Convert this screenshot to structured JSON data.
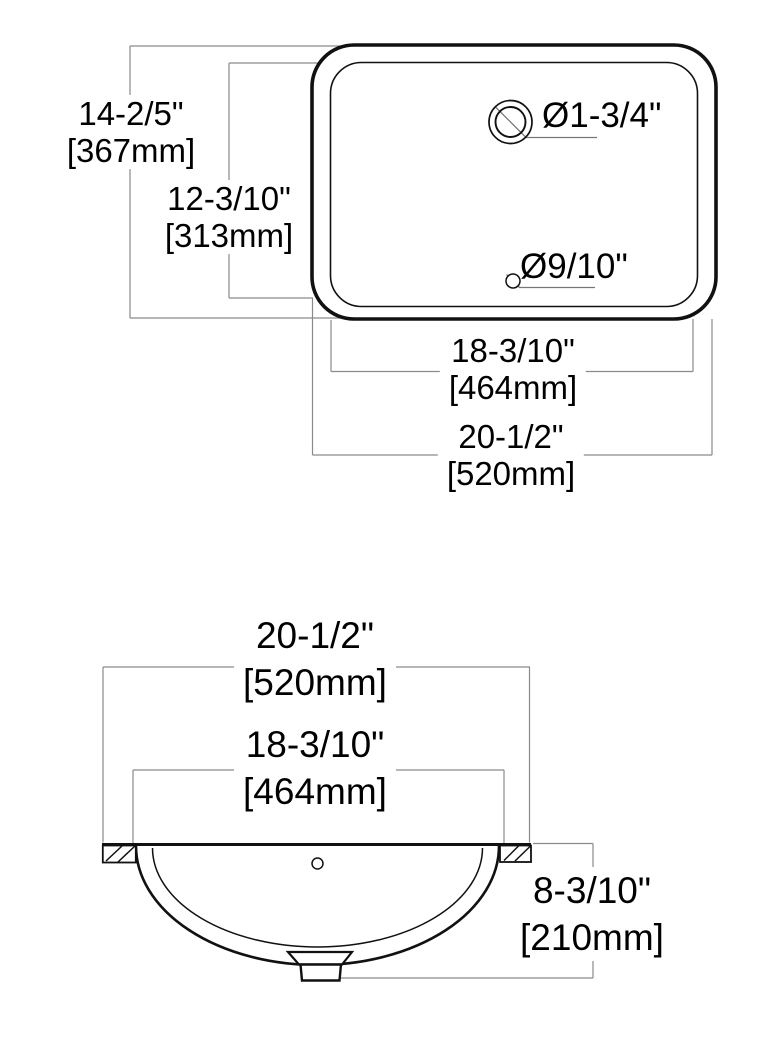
{
  "top_view": {
    "overall_height": {
      "inches": "14-2/5\"",
      "mm": "[367mm]"
    },
    "basin_height": {
      "inches": "12-3/10\"",
      "mm": "[313mm]"
    },
    "faucet_hole_diameter": "Ø1-3/4\"",
    "overflow_hole_diameter": "Ø9/10\"",
    "basin_width": {
      "inches": "18-3/10\"",
      "mm": "[464mm]"
    },
    "overall_width": {
      "inches": "20-1/2\"",
      "mm": "[520mm]"
    }
  },
  "front_view": {
    "overall_width": {
      "inches": "20-1/2\"",
      "mm": "[520mm]"
    },
    "basin_width": {
      "inches": "18-3/10\"",
      "mm": "[464mm]"
    },
    "depth": {
      "inches": "8-3/10\"",
      "mm": "[210mm]"
    }
  },
  "colors": {
    "outline": "#111111",
    "dim_line": "#8a8a8a",
    "text": "#000000",
    "background": "#ffffff"
  }
}
